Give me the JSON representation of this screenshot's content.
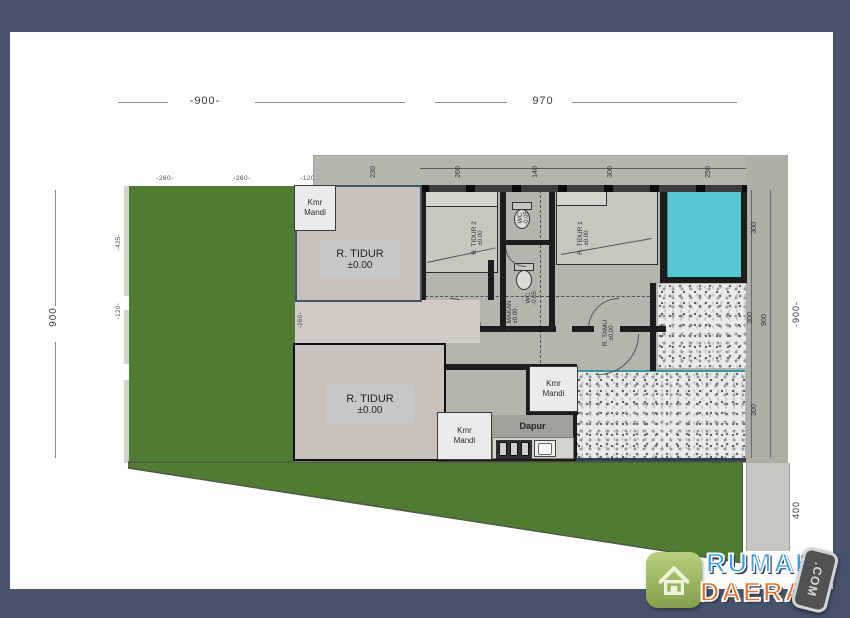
{
  "colors": {
    "border": "#47536b",
    "page": "#fefefe",
    "green": "#4f7b33",
    "scan": "#b4b6ae",
    "beige": "#c9c1bb",
    "cyan": "#55c8d2",
    "wall": "#1c1c1c",
    "logo_blue": "#3aa0e8",
    "logo_orange": "#e4702a"
  },
  "dims": {
    "top_left": "-900-",
    "top_right": "970",
    "left_v": "900",
    "right_v": "-900-",
    "right_road": "400",
    "top_small": [
      "-260-",
      "-260-",
      "-120-",
      "-260-"
    ],
    "left_small": [
      "-425-",
      "-120-"
    ],
    "hall_small": "-260-",
    "scan_top": [
      "230",
      "260",
      "140",
      "300",
      "250"
    ],
    "scan_right": [
      "300",
      "300",
      "900",
      "300"
    ]
  },
  "rooms": {
    "kmr_mandi": {
      "l1": "Kmr",
      "l2": "Mandi"
    },
    "tidur_top": {
      "name": "R. TIDUR",
      "level": "±0.00"
    },
    "tidur_bottom": {
      "name": "R. TIDUR",
      "level": "±0.00"
    },
    "tidur2": {
      "name": "R. TIDUR 2",
      "level": "±0.00"
    },
    "tidur1": {
      "name": "R. TIDUR 1",
      "level": "±0.00"
    },
    "wc_top": {
      "name": "WC",
      "level": "-0.05"
    },
    "wc_bottom": {
      "name": "WC",
      "level": "-0.05"
    },
    "makan": {
      "name": "R. MAKAN",
      "level": "±0.00"
    },
    "tamu": {
      "name": "R. TAMU",
      "level": "±0.00"
    },
    "dapur": "Dapur"
  },
  "logo": {
    "word1": "RUMAH",
    "word2": "DAERAH",
    "tag": ".COM"
  }
}
